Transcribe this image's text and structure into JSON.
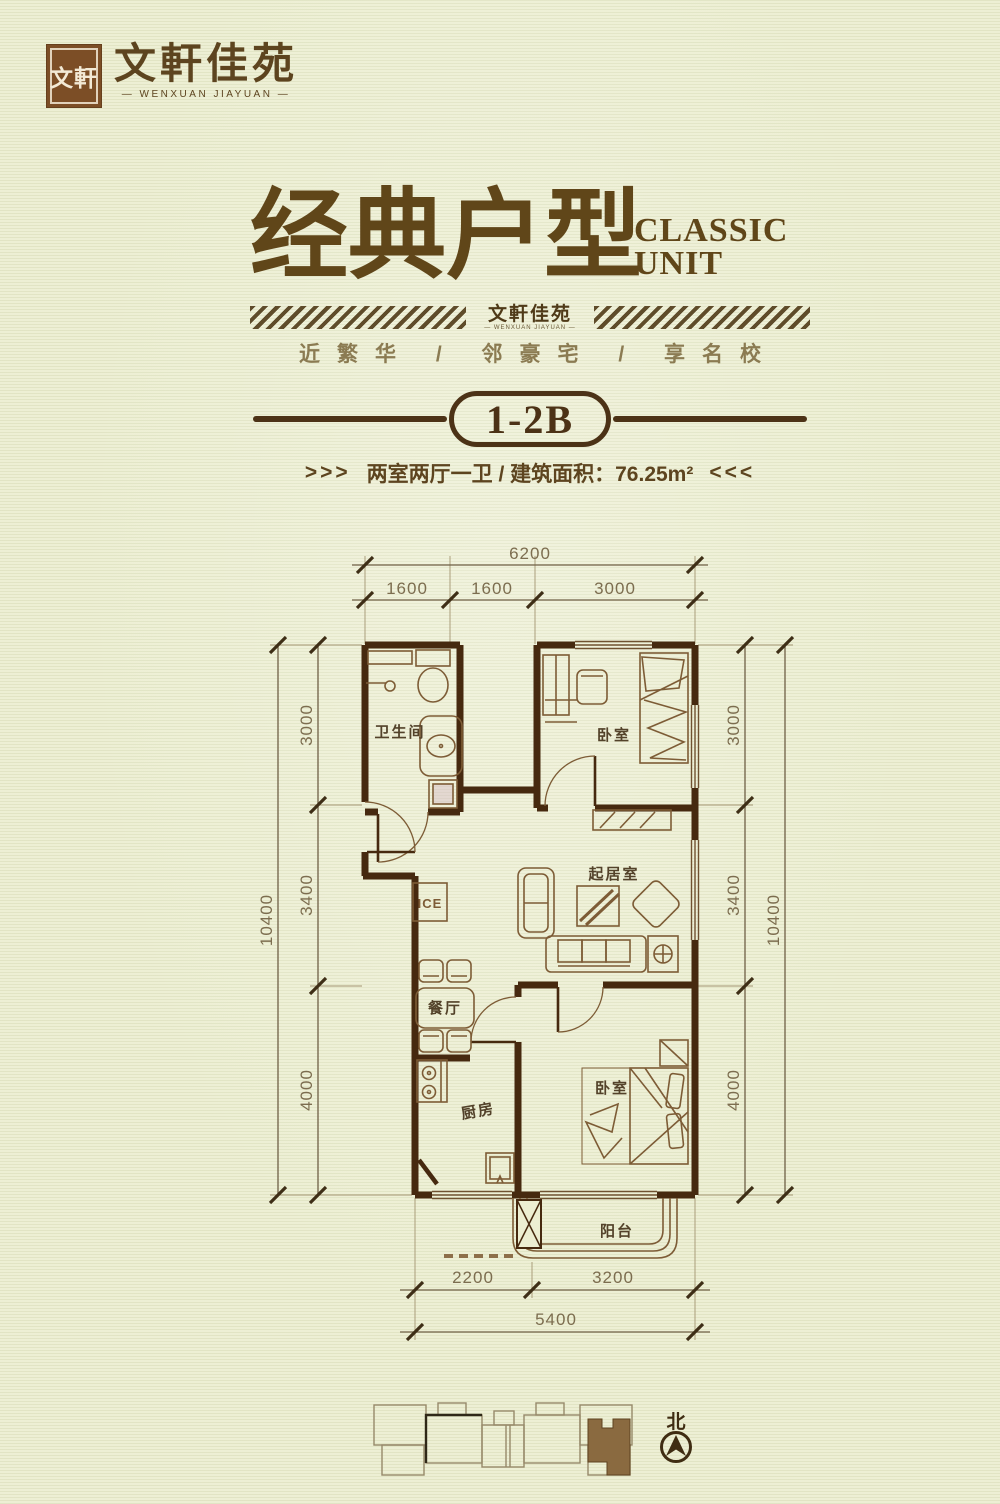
{
  "palette": {
    "ink": "#5d441f",
    "wall": "#46290f",
    "accent": "#4c3216",
    "dim_text": "#7c6d4f",
    "paper": "#eceed2",
    "highlight_unit_fill": "#8a6a40"
  },
  "logo": {
    "seal": "文軒",
    "name": "文軒佳苑",
    "name_en": "— WENXUAN JIAYUAN —"
  },
  "hero": {
    "title": "经典户型",
    "title_en1": "CLASSIC",
    "title_en2": "UNIT",
    "band_name": "文軒佳苑",
    "band_name_en": "— WENXUAN JIAYUAN —",
    "tagline": "近繁华 / 邻豪宅 / 享名校",
    "unit": "1-2B",
    "spec_arrow_l": ">>>",
    "spec": "两室两厅一卫 / 建筑面积：76.25m²",
    "spec_arrow_r": "<<<"
  },
  "plan": {
    "rooms": {
      "bath": "卫生间",
      "bed1": "卧室",
      "living": "起居室",
      "dining": "餐厅",
      "kitchen": "厨房",
      "bed2": "卧室",
      "balcony": "阳台",
      "fridge": "ICE"
    },
    "dims": {
      "top_total": "6200",
      "top_segments": [
        "1600",
        "1600",
        "3000"
      ],
      "side_total": "10400",
      "side_segments": [
        "3000",
        "3400",
        "4000"
      ],
      "bottom_segments": [
        "2200",
        "3200"
      ],
      "bottom_total": "5400"
    },
    "north": "北"
  }
}
